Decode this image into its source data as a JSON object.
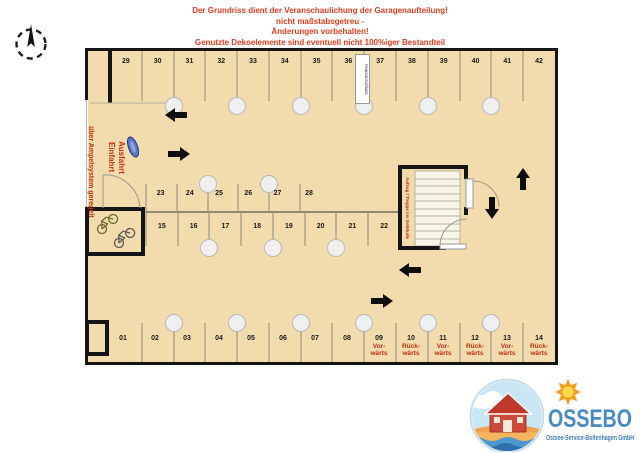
{
  "disclaimer": {
    "lines": [
      "Der Grundriss dient der Veranschaulichung der Garagenaufteilung!",
      "nicht maßstabsgetreu -",
      "Änderungen vorbehalten!",
      "Genutzte Dekoelemente sind eventuell nicht 100%iger Bestandteil",
      "der Ausstattung!"
    ]
  },
  "plan": {
    "entry": {
      "regulated": "über Ampelsystem geregelt",
      "einfahrt": "Einfahrt",
      "ausfahrt": "Ausfahrt"
    },
    "hausanschluss": "Hausanschluss",
    "stairwell": "Aufzug / Treppe ins Gebäude",
    "top_row": [
      "29",
      "30",
      "31",
      "32",
      "33",
      "34",
      "35",
      "36",
      "37",
      "38",
      "39",
      "40",
      "41",
      "42"
    ],
    "island_top": [
      "23",
      "24",
      "25",
      "26",
      "27",
      "28"
    ],
    "island_bottom": [
      "15",
      "16",
      "17",
      "18",
      "19",
      "20",
      "21",
      "22"
    ],
    "bottom_row": [
      "01",
      "02",
      "03",
      "04",
      "05",
      "06",
      "07",
      "08"
    ],
    "bottom_row_directional": [
      {
        "num": "09",
        "dir": "Vor-\nwärts"
      },
      {
        "num": "10",
        "dir": "Rück-\nwärts"
      },
      {
        "num": "11",
        "dir": "Vor-\nwärts"
      },
      {
        "num": "12",
        "dir": "Rück-\nwärts"
      },
      {
        "num": "13",
        "dir": "Vor-\nwärts"
      },
      {
        "num": "14",
        "dir": "Rück-\nwärts"
      }
    ],
    "colors": {
      "floor": "#f2dbad",
      "wall": "#151515",
      "label_red": "#c22f0e",
      "disclaimer_red": "#e03c1c"
    },
    "icons": {
      "compass": "north-compass-icon",
      "bicycles": "bicycle-icon",
      "barrier": "traffic-barrier-icon",
      "pillar": "pillar-column",
      "arrows": "driving-direction-arrow"
    }
  },
  "logo": {
    "brand": "OSSEBO",
    "subtitle": "Ostsee-Service-Boltenhagen GmbH",
    "colors": {
      "blue": "#4a8ac4",
      "house_red": "#c03a2b",
      "sand": "#f2a24b"
    }
  }
}
